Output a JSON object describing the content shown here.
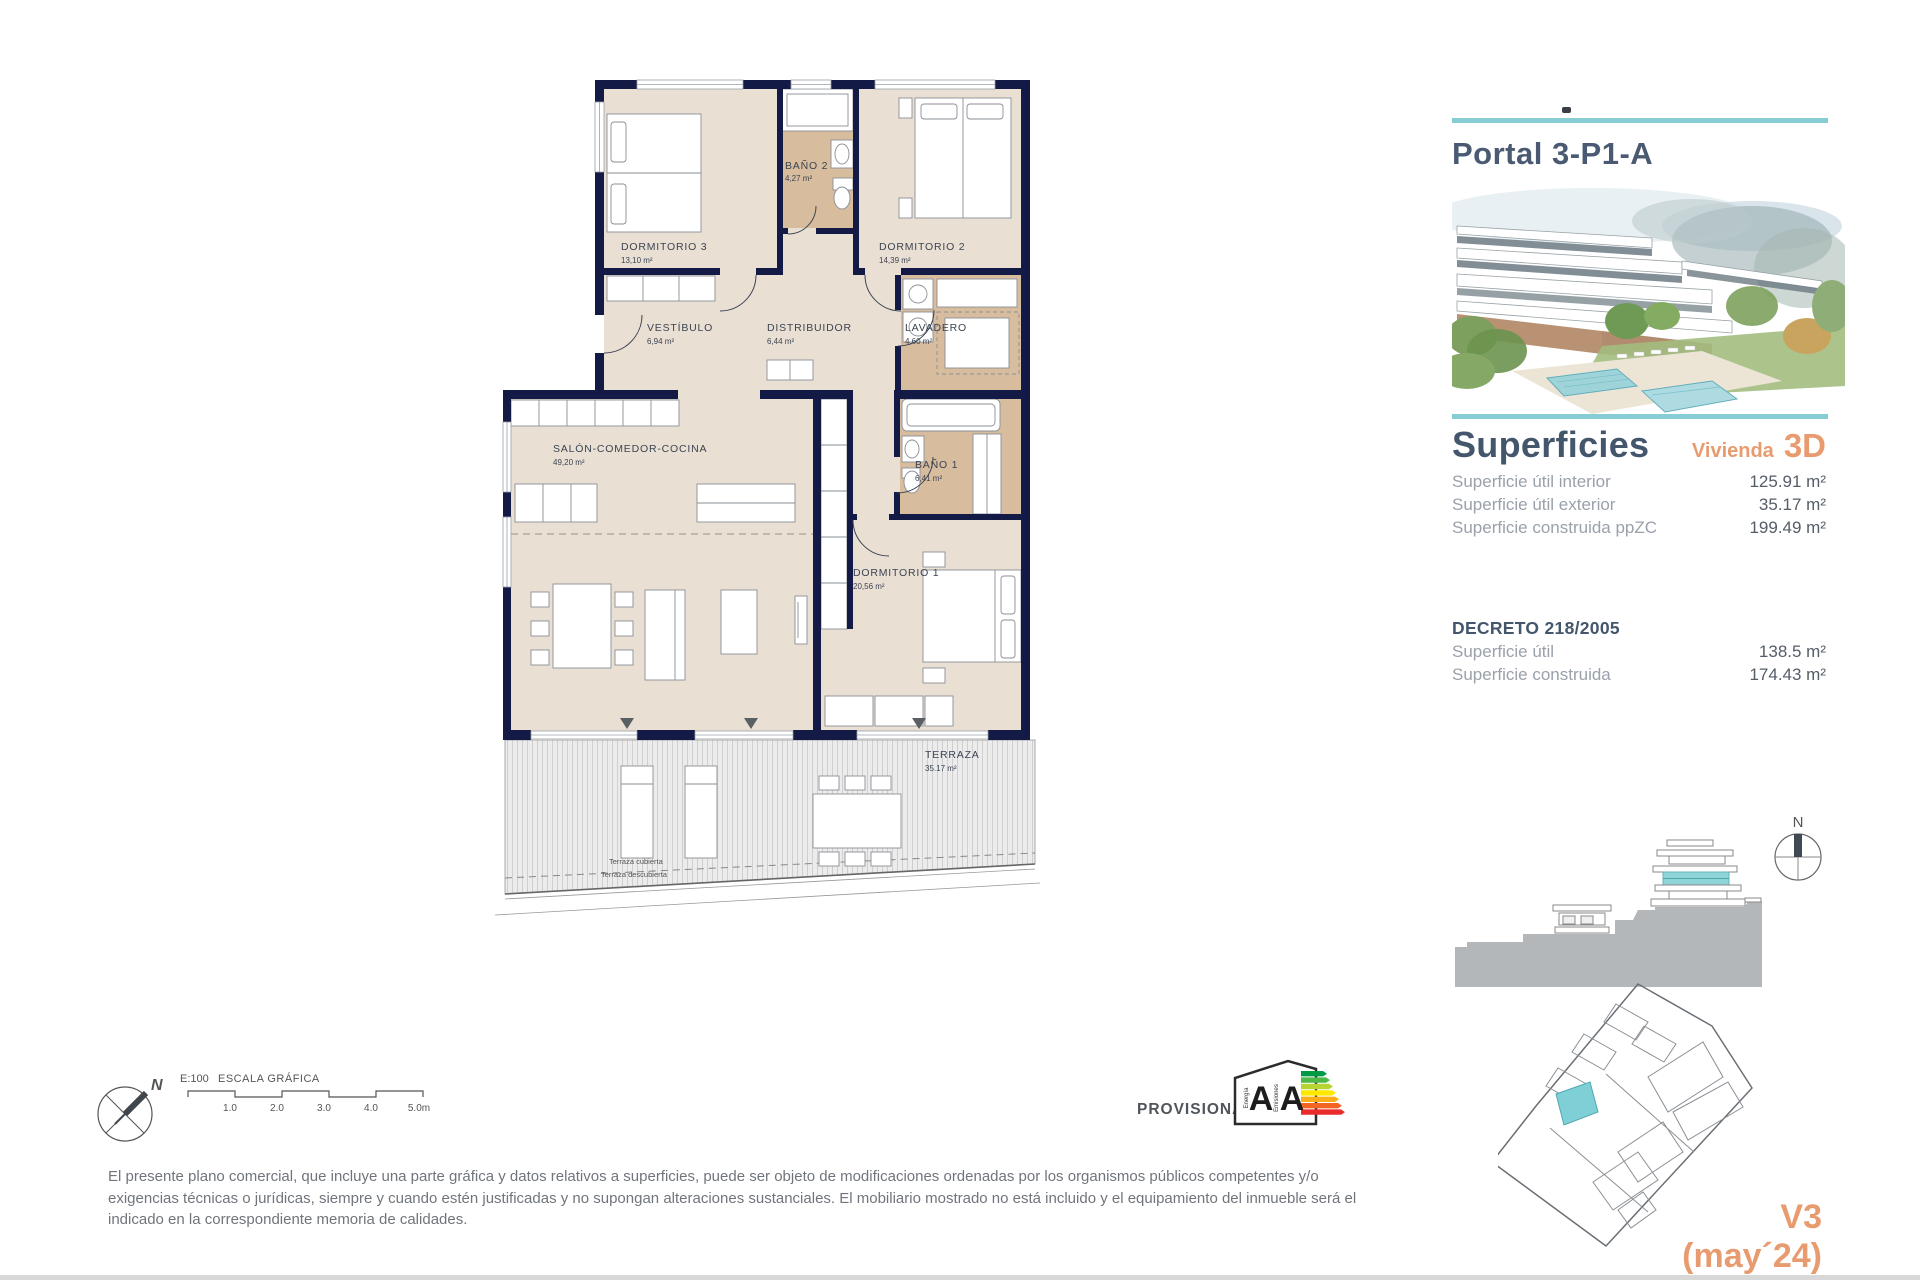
{
  "floorplan": {
    "rooms": [
      {
        "name": "DORMITORIO 3",
        "area": "13,10 m²"
      },
      {
        "name": "BAÑO 2",
        "area": "4,27 m²"
      },
      {
        "name": "DORMITORIO 2",
        "area": "14,39 m²"
      },
      {
        "name": "VESTÍBULO",
        "area": "6,94 m²"
      },
      {
        "name": "DISTRIBUIDOR",
        "area": "6,44 m²"
      },
      {
        "name": "LAVADERO",
        "area": "4,60 m²"
      },
      {
        "name": "SALÓN-COMEDOR-COCINA",
        "area": "49,20 m²"
      },
      {
        "name": "BAÑO 1",
        "area": "6,41 m²"
      },
      {
        "name": "DORMITORIO 1",
        "area": "20,56 m²"
      },
      {
        "name": "TERRAZA",
        "area": "35.17 m²"
      }
    ],
    "terrace_covered": "Terraza cubierta",
    "terrace_uncovered": "Terraza descubierta"
  },
  "scale": {
    "ratio": "E:100",
    "title": "ESCALA GRÁFICA",
    "ticks": [
      "1.0",
      "2.0",
      "3.0",
      "4.0",
      "5.0m"
    ]
  },
  "compass": {
    "north": "N"
  },
  "provisional_label": "PROVISIONAL",
  "energy_label": {
    "word_energy": "Energía",
    "word_emissions": "Emisiones",
    "letter_energy": "A",
    "letter_emissions": "A",
    "scale_colors": [
      "#009a44",
      "#4db848",
      "#b8d432",
      "#ffe800",
      "#fbae17",
      "#f26522",
      "#e92b2b"
    ]
  },
  "sidebar": {
    "title": "Portal 3-P1-A",
    "superficies": {
      "heading": "Superficies",
      "vivienda_label": "Vivienda",
      "vivienda_code": "3D",
      "rows": [
        {
          "label": "Superficie útil interior",
          "value": "125.91 m²"
        },
        {
          "label": "Superficie útil exterior",
          "value": "35.17 m²"
        },
        {
          "label": "Superficie construida ppZC",
          "value": "199.49 m²"
        }
      ]
    },
    "decreto": {
      "heading": "DECRETO 218/2005",
      "rows": [
        {
          "label": "Superficie útil",
          "value": "138.5 m²"
        },
        {
          "label": "Superficie construida",
          "value": "174.43 m²"
        }
      ]
    },
    "section_compass_north": "N",
    "version": "V3",
    "version_date": "(may´24)"
  },
  "disclaimer": {
    "lines": [
      "El presente plano comercial, que incluye una parte gráfica y datos relativos a superficies, puede ser objeto de modificaciones ordenadas por los organismos públicos competentes y/o",
      "exigencias técnicas o jurídicas, siempre y cuando estén justificadas y no supongan alteraciones sustanciales. El mobiliario mostrado no está incluido y el equipamiento del inmueble será el",
      "indicado en la correspondiente memoria de calidades."
    ]
  },
  "colors": {
    "wall_navy": "#121a45",
    "floor_beige": "#eadfd3",
    "wet_room_tan": "#d8bc9e",
    "accent_teal": "#87ced4",
    "accent_orange": "#e89b6e",
    "heading_blue": "#44566b"
  }
}
